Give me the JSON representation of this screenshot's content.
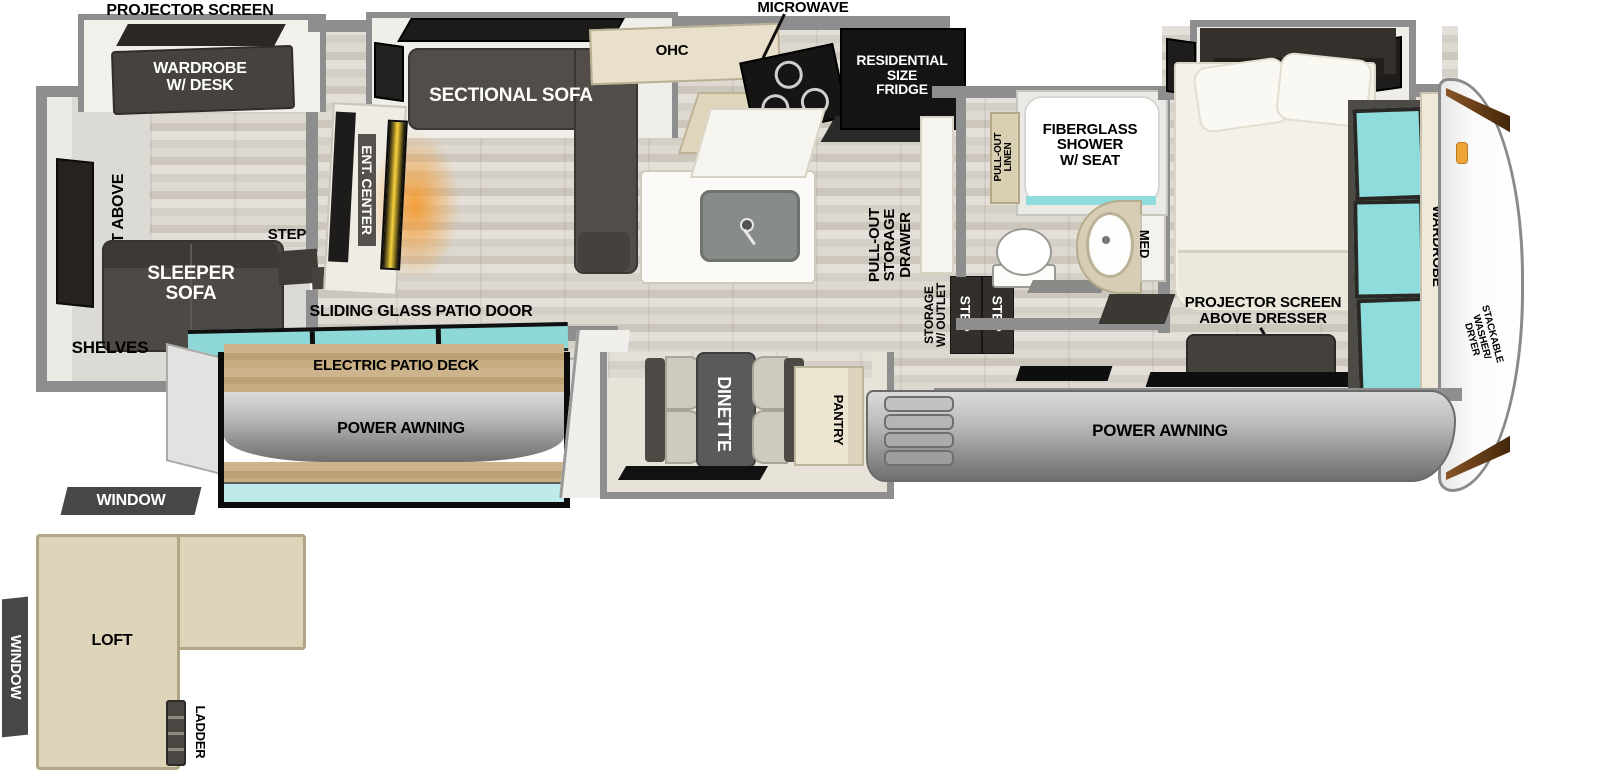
{
  "title": "Fifth wheel travel trailer floor plan",
  "colors": {
    "wall": "#8e8e8e",
    "floor_wood": "#d9d4cb",
    "dark_furniture": "#4a4540",
    "appliance_black": "#161616",
    "cabinet_cream": "#e7dfc9",
    "counter_tan": "#d9cfb2",
    "window_teal": "#8fdcdc",
    "deck_wood": "#c3a87f",
    "awning_gray": "#a7a7a7",
    "loft_fill": "#ded4b9",
    "fireplace_orange": "#f59b2e"
  },
  "rear_room": {
    "projector_screen": "PROJECTOR SCREEN",
    "wardrobe_desk": "WARDROBE\nW/ DESK",
    "loft_above": "LOFT ABOVE",
    "sleeper_sofa": "SLEEPER\nSOFA",
    "shelves": "SHELVES",
    "step": "STEP"
  },
  "living": {
    "sectional_sofa": "SECTIONAL SOFA",
    "ent_center": "ENT. CENTER",
    "ohc": "OHC",
    "sliding_glass_patio_door": "SLIDING GLASS PATIO DOOR"
  },
  "kitchen": {
    "microwave": "MICROWAVE",
    "fridge": "RESIDENTIAL\nSIZE\nFRIDGE",
    "pull_out_storage_drawer": "PULL-OUT\nSTORAGE\nDRAWER"
  },
  "entry": {
    "storage_w_outlet": "STORAGE\nW/ OUTLET",
    "step": "STEP"
  },
  "bath": {
    "pull_out_linen": "PULL-OUT\nLINEN",
    "shower": "FIBERGLASS\nSHOWER\nW/ SEAT",
    "med": "MED"
  },
  "bedroom": {
    "projector_screen_above_dresser": "PROJECTOR SCREEN\nABOVE DRESSER",
    "wardrobe": "WARDROBE",
    "prep": "PREP",
    "stackable_washer_dryer": "STACKABLE\nWASHER/\nDRYER"
  },
  "dinette_slide": {
    "dinette": "DINETTE",
    "pantry": "PANTRY"
  },
  "patio": {
    "electric_patio_deck": "ELECTRIC PATIO DECK",
    "power_awning": "POWER AWNING",
    "window": "WINDOW"
  },
  "exterior": {
    "power_awning": "POWER AWNING"
  },
  "loft": {
    "label": "LOFT",
    "ladder": "LADDER",
    "window_top": "WINDOW",
    "window_side": "WINDOW"
  }
}
